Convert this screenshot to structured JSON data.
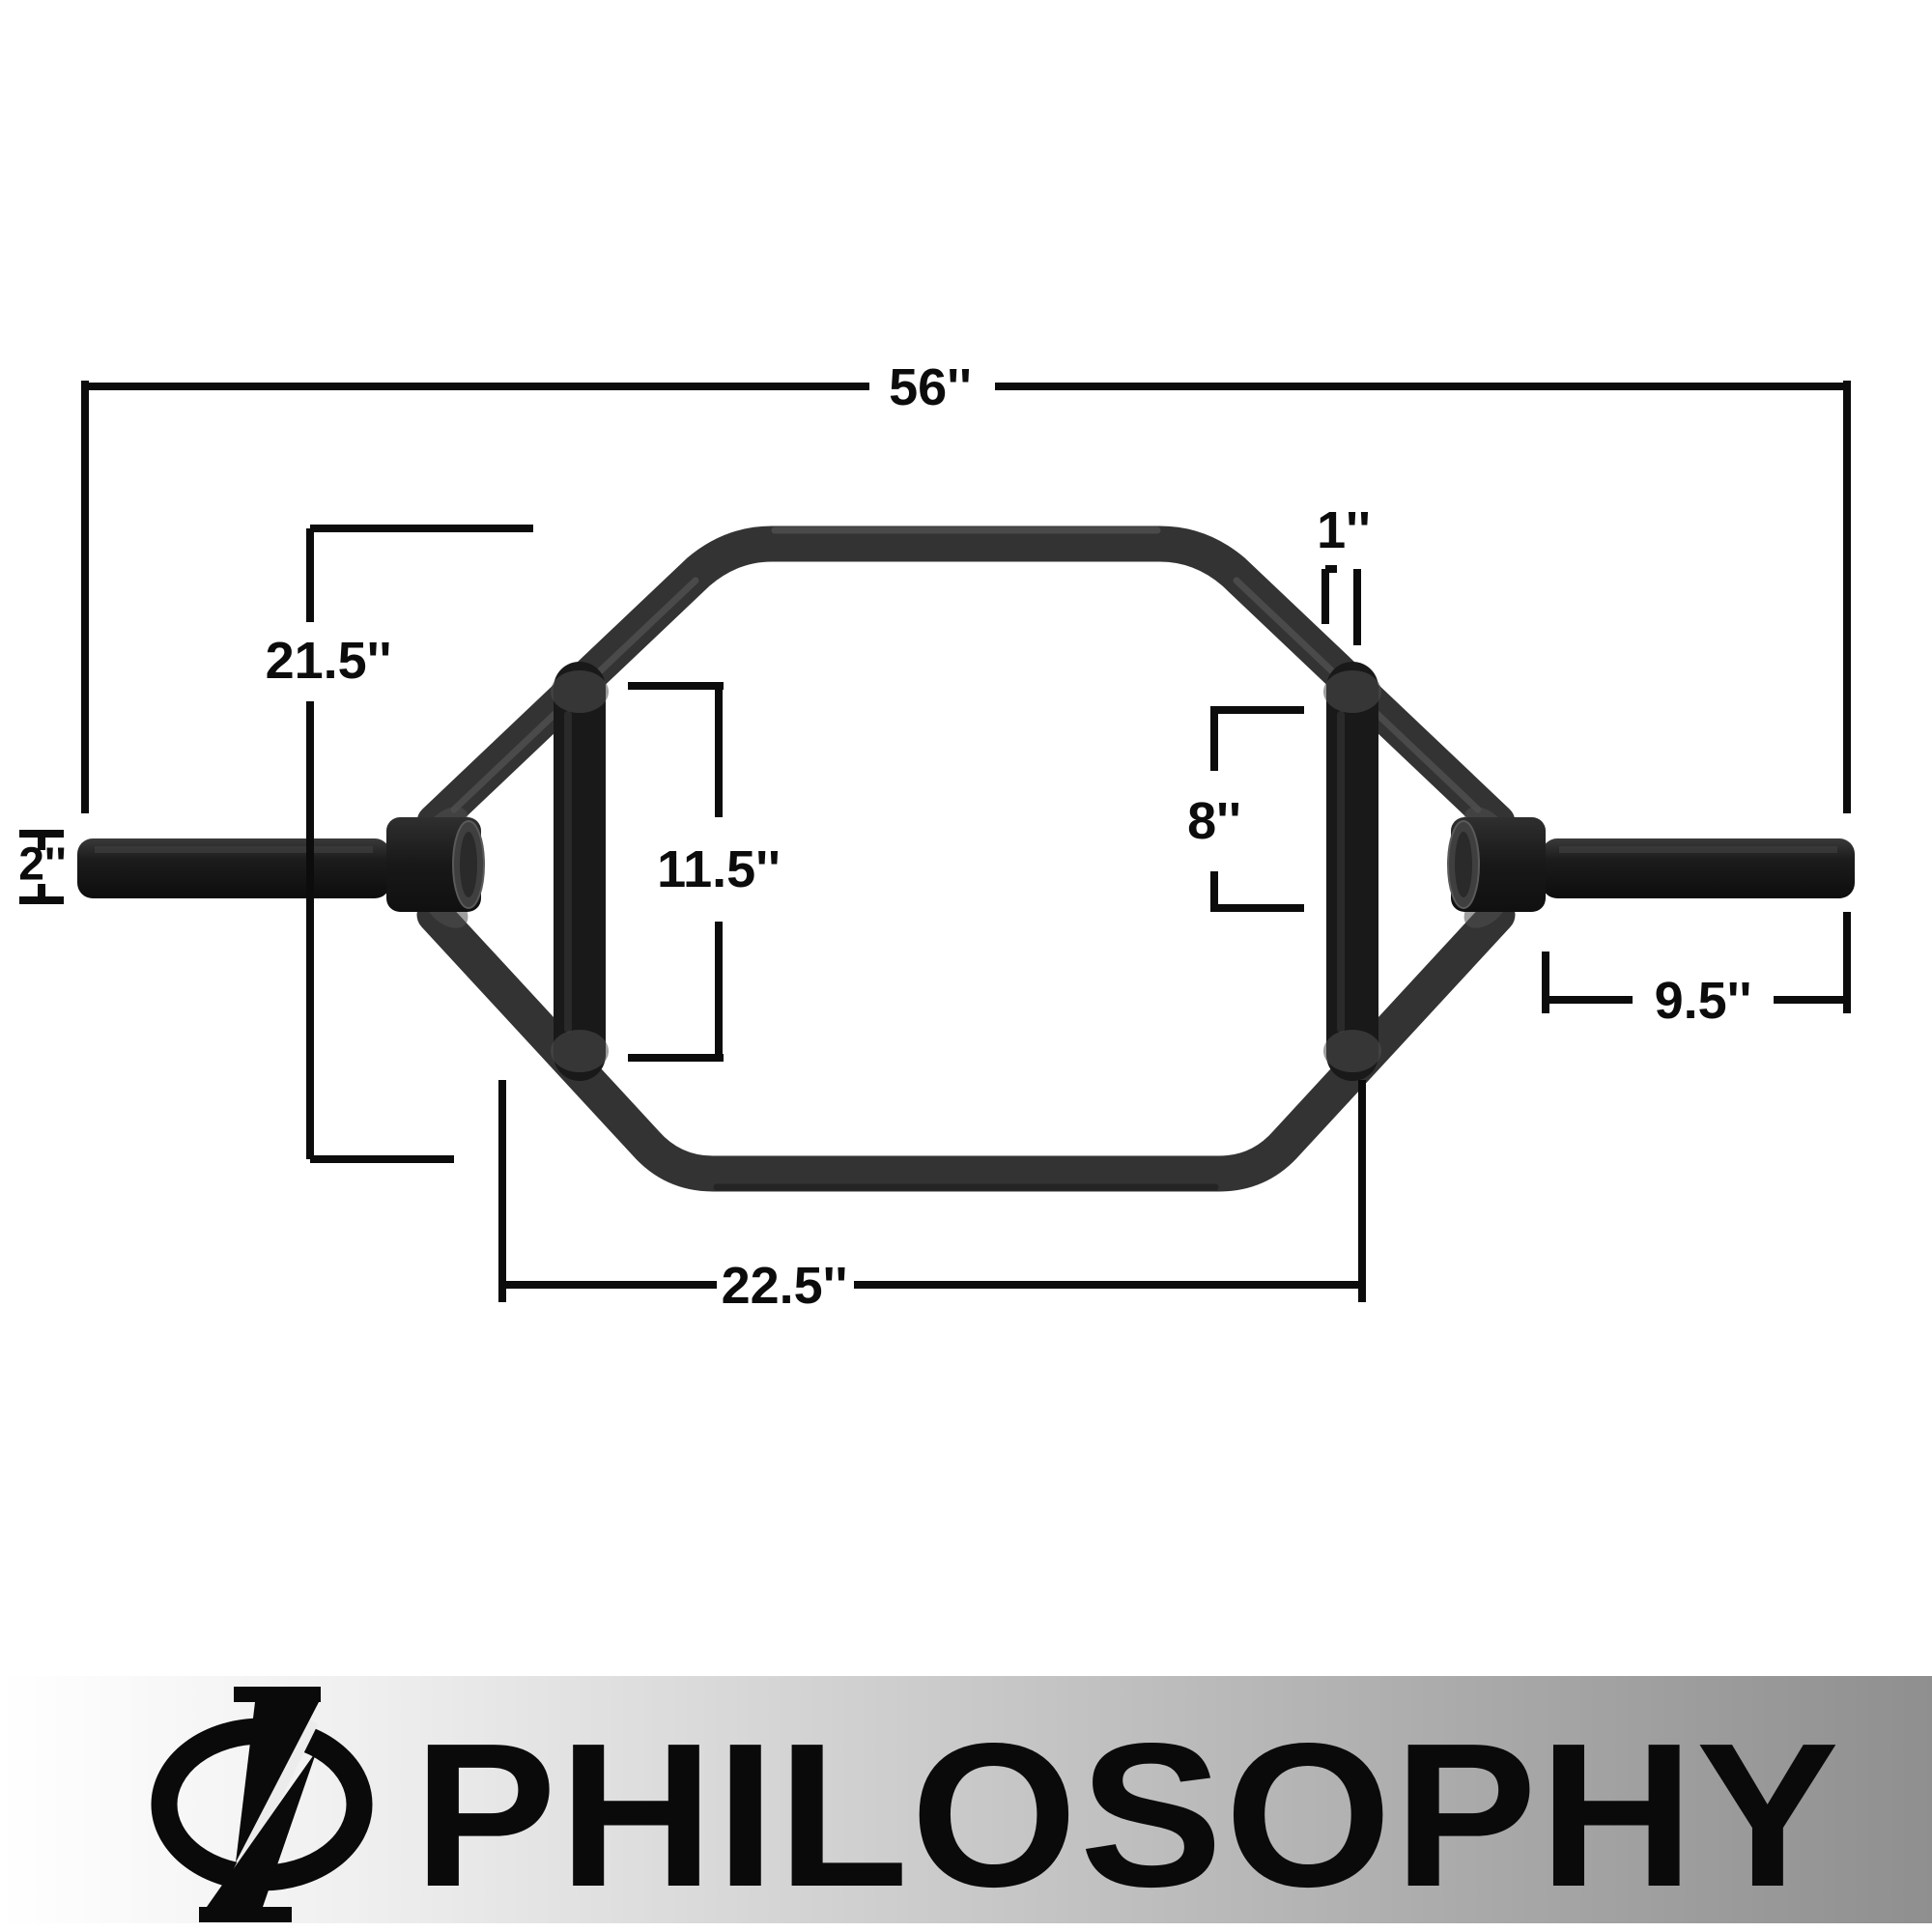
{
  "diagram": {
    "dimensions": {
      "total_length": "56''",
      "frame_height": "21.5''",
      "sleeve_diameter": "2''",
      "handle_length": "11.5''",
      "handle_diameter": "1''",
      "grip_section": "8''",
      "sleeve_length": "9.5''",
      "base_width": "22.5''"
    },
    "colors": {
      "bar": "#333333",
      "dimension_lines": "#0c0c0c",
      "background": "#ffffff"
    }
  },
  "brand": {
    "name": "PHILOSOPHY",
    "logo_icon": "phi-circle-slash",
    "text_color": "#0a0a0a",
    "banner_gradient_start": "#ffffff",
    "banner_gradient_end": "#8f8f8f"
  }
}
